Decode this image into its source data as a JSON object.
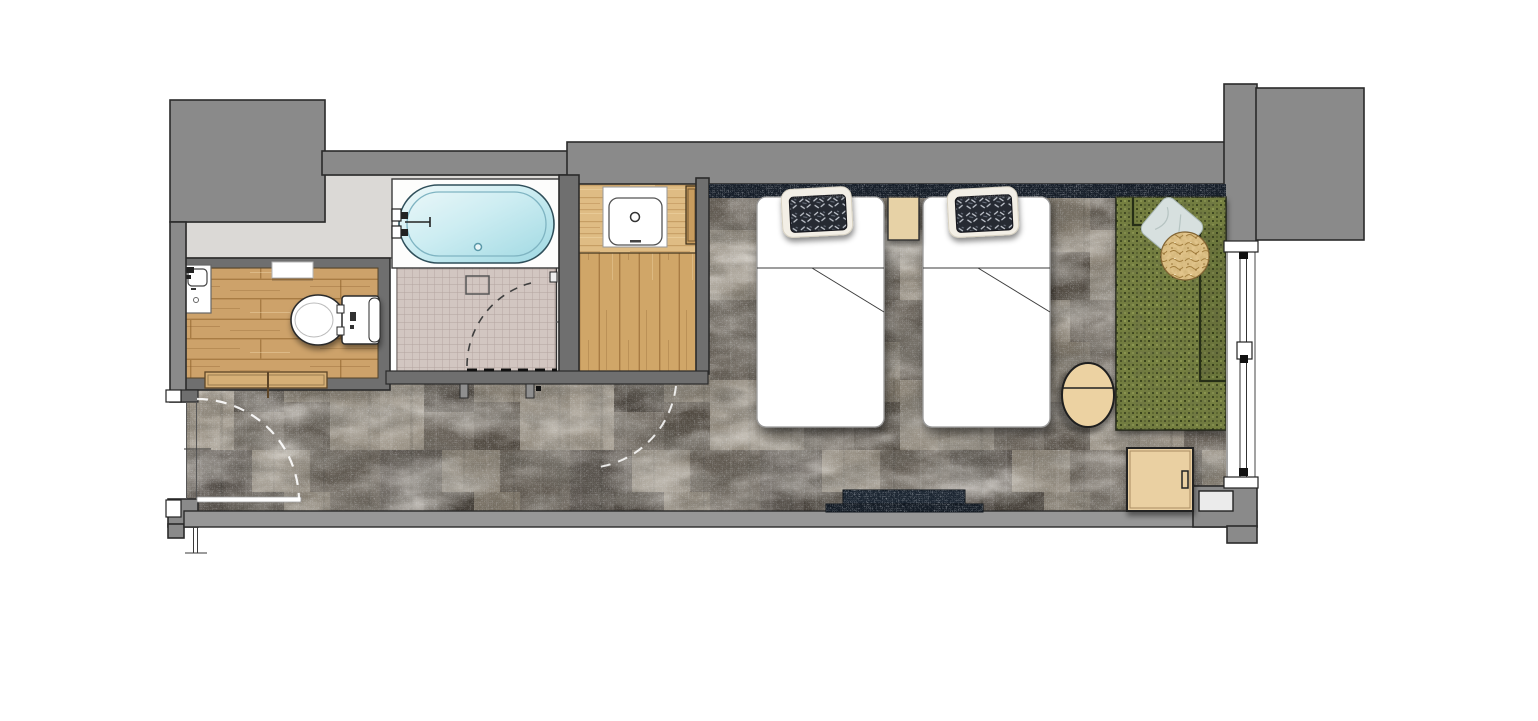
{
  "canvas": {
    "width": 1538,
    "height": 721,
    "background": "#ffffff"
  },
  "plan": {
    "type": "hotel-guestroom-floor-plan",
    "rooms": [
      {
        "id": "toilet-room"
      },
      {
        "id": "bathroom-tub-and-shower"
      },
      {
        "id": "vanity-room"
      },
      {
        "id": "entry-hall"
      },
      {
        "id": "bedroom"
      }
    ],
    "fixtures": [
      "corner-hand-basin",
      "toilet",
      "wall-shelf",
      "bathtub",
      "bath-faucet",
      "overflow-drain",
      "shower-wet-area",
      "floor-drain-box",
      "shower-door",
      "washbasin",
      "vanity-counter",
      "vanity-tall-cabinet"
    ],
    "furniture": [
      "twin-bed-1",
      "twin-bed-2",
      "bed-pillow-1",
      "bed-pillow-2",
      "nightstand",
      "headboard-panel",
      "tv-console",
      "sofa-daybed",
      "sofa-blue-pillow",
      "round-gold-cushion",
      "round-side-table",
      "luggage-cabinet",
      "floor-step-unit"
    ],
    "openings": [
      "entry-door-swing",
      "toilet-sliding-door",
      "shower-door-swing",
      "vanity-door-swing",
      "window-wall"
    ]
  },
  "palette": {
    "background": "#ffffff",
    "wall": "#8a8a8a",
    "wall_inner": "#6f6f6f",
    "wall_light": "#979797",
    "bath_floor": "#dbd9d6",
    "tile": "#d2c6c1",
    "tile_line": "#b3a49f",
    "wood_floor": "#cda26a",
    "wood_counter": "#dfbc84",
    "wood_threshold": "#d6b077",
    "wood_cabinet": "#c89c5e",
    "fixture_white": "#ffffff",
    "tub_rim": "#7fb4c2",
    "tub_water": "#bfe7ee",
    "carpet": "#6e675e",
    "carpet_dark": "#433d36",
    "carpet_light": "#9c9487",
    "headboard": "#141c27",
    "console": "#1a2430",
    "console_lower": "#131b25",
    "bed": "#ffffff",
    "pillow_dark": "#262b33",
    "pillow_trim": "#f3efe6",
    "nightstand": "#e7d2a6",
    "sofa": "#75803f",
    "sofa_dot": "#39421c",
    "sofa_pillow": "#d7e0df",
    "cushion": "#e2c58c",
    "table": "#ecd2a2",
    "cabinet": "#ead0a2",
    "step": "#ebebeb"
  }
}
